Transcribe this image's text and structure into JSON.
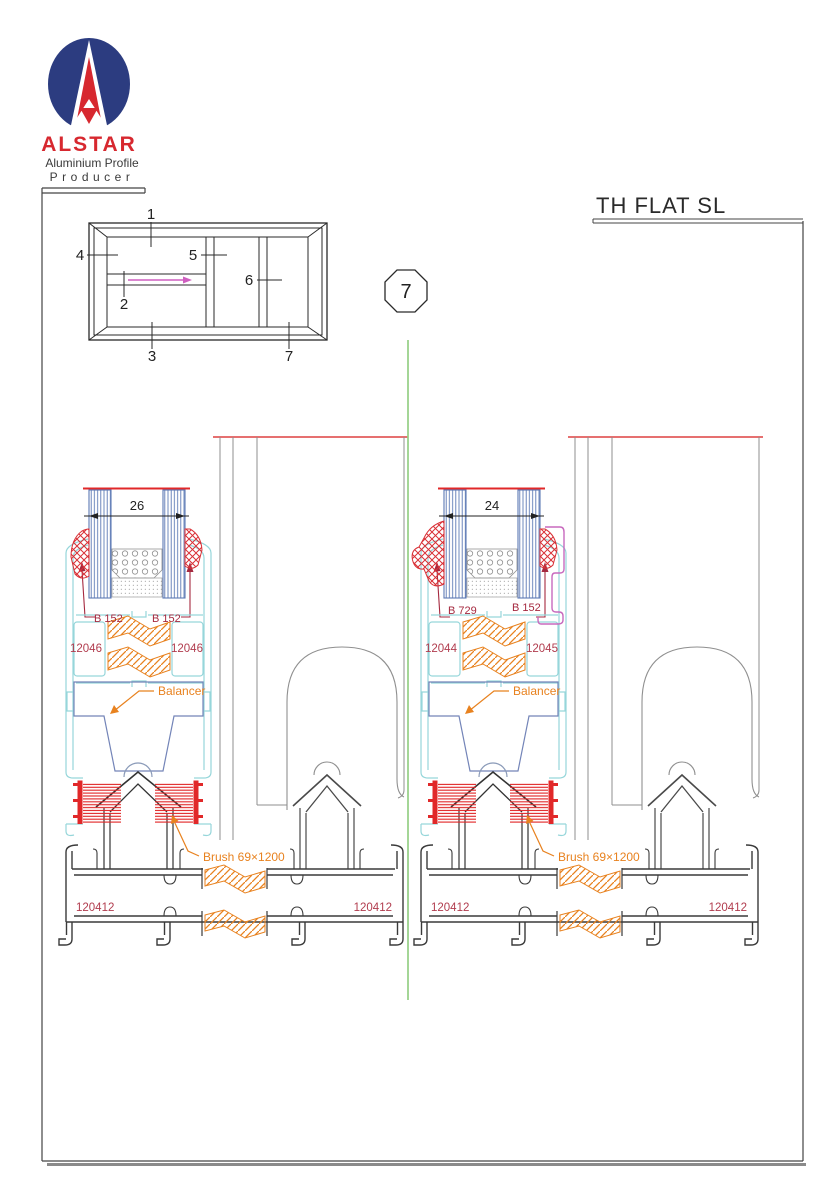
{
  "sheet": {
    "title": "TH FLAT SL",
    "section_number": "7"
  },
  "logo": {
    "brand": "ALSTAR",
    "subtitle_line1": "Aluminium Profile",
    "subtitle_line2": "Producer"
  },
  "schematic": {
    "callouts": {
      "c1": "1",
      "c2": "2",
      "c3": "3",
      "c4": "4",
      "c5": "5",
      "c6": "6",
      "c7": "7"
    }
  },
  "details": {
    "left": {
      "glass_width": "26",
      "gasket_left": "B 152",
      "gasket_right": "B 152",
      "chamber_left": "12046",
      "chamber_right": "12046",
      "balancer_label": "Balancer",
      "brush_label": "Brush 69×1200",
      "frame_left": "120412",
      "frame_right": "120412"
    },
    "right": {
      "glass_width": "24",
      "gasket_left": "B 729",
      "gasket_right": "B 152",
      "chamber_left": "12044",
      "chamber_right": "12045",
      "balancer_label": "Balancer",
      "brush_label": "Brush 69×1200",
      "frame_left": "120412",
      "frame_right": "120412"
    }
  },
  "colors": {
    "logo_navy": "#2c3c80",
    "logo_red": "#d7282f",
    "profile_cyan": "#96d6da",
    "glass_blue": "#5c79b5",
    "gasket_red": "#d93036",
    "brush_red": "#e12829",
    "label_crimson": "#b13c4e",
    "accent_orange": "#e8821f",
    "bead_magenta": "#c869be",
    "axis_green": "#94cf85",
    "cut_line_red": "#e25b5b",
    "balancer_blue": "#7384b8",
    "profile_gray": "#8f8f8f",
    "line_dark": "#3a3a3a"
  }
}
